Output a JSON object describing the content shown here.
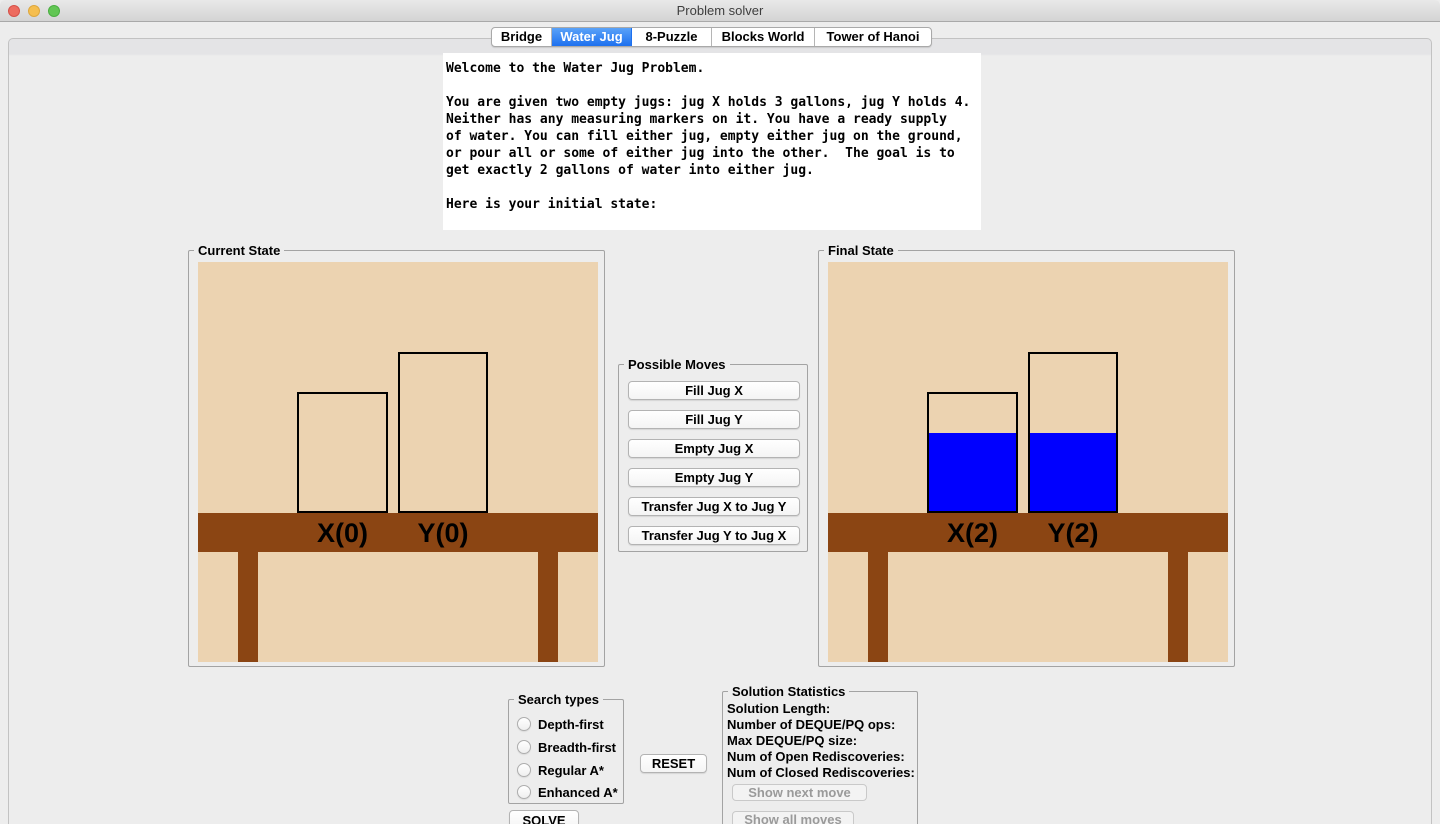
{
  "window": {
    "title": "Problem solver"
  },
  "tabs": {
    "items": [
      "Bridge",
      "Water Jug",
      "8-Puzzle",
      "Blocks World",
      "Tower of Hanoi"
    ],
    "active": "Water Jug"
  },
  "welcome_text": "Welcome to the Water Jug Problem.\n\nYou are given two empty jugs: jug X holds 3 gallons, jug Y holds 4.\nNeither has any measuring markers on it. You have a ready supply\nof water. You can fill either jug, empty either jug on the ground,\nor pour all or some of either jug into the other.  The goal is to\nget exactly 2 gallons of water into either jug.\n\nHere is your initial state:",
  "current_state": {
    "title": "Current State",
    "jugs": [
      {
        "name": "X",
        "capacity": 3,
        "amount": 0,
        "label": "X(0)"
      },
      {
        "name": "Y",
        "capacity": 4,
        "amount": 0,
        "label": "Y(0)"
      }
    ]
  },
  "final_state": {
    "title": "Final State",
    "jugs": [
      {
        "name": "X",
        "capacity": 3,
        "amount": 2,
        "label": "X(2)"
      },
      {
        "name": "Y",
        "capacity": 4,
        "amount": 2,
        "label": "Y(2)"
      }
    ]
  },
  "possible_moves": {
    "title": "Possible Moves",
    "buttons": [
      "Fill Jug X",
      "Fill Jug Y",
      "Empty Jug X",
      "Empty Jug Y",
      "Transfer Jug X to Jug Y",
      "Transfer Jug Y to Jug X"
    ]
  },
  "search_types": {
    "title": "Search types",
    "options": [
      "Depth-first",
      "Breadth-first",
      "Regular A*",
      "Enhanced A*"
    ]
  },
  "controls": {
    "reset": "RESET",
    "solve": "SOLVE",
    "show_next": "Show next move",
    "show_all": "Show all moves"
  },
  "solution_statistics": {
    "title": "Solution Statistics",
    "lines": [
      "Solution Length:",
      "Number of DEQUE/PQ ops:",
      "Max DEQUE/PQ size:",
      "Num of Open Rediscoveries:",
      "Num of Closed Rediscoveries:"
    ]
  },
  "colors": {
    "water": "#0000ff",
    "table": "#8b4513",
    "room_background": "#ecd3b1",
    "selected_tab": "#1d70ef"
  }
}
